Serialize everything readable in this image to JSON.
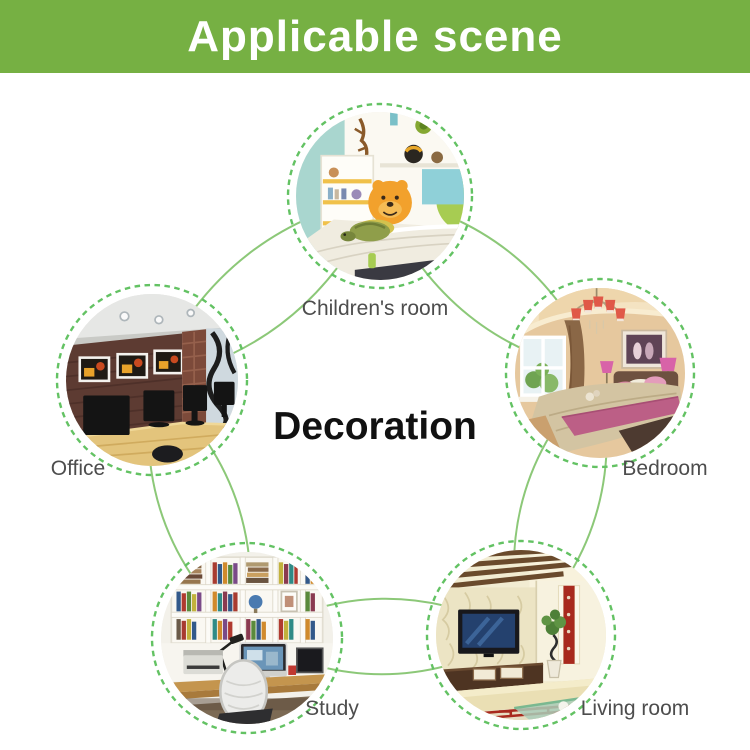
{
  "header": {
    "title": "Applicable scene"
  },
  "center": {
    "label": "Decoration"
  },
  "scenes": [
    {
      "key": "childrens-room",
      "label": "Children's room"
    },
    {
      "key": "bedroom",
      "label": "Bedroom"
    },
    {
      "key": "living-room",
      "label": "Living room"
    },
    {
      "key": "study",
      "label": "Study"
    },
    {
      "key": "office",
      "label": "Office"
    }
  ],
  "colors": {
    "page_bg": "#ffffff",
    "header_bg": "#76b043",
    "header_text": "#ffffff",
    "connector": "#8cc878",
    "ring": "#63c263",
    "label_text": "#4d4d4d",
    "center_text": "#111111"
  }
}
